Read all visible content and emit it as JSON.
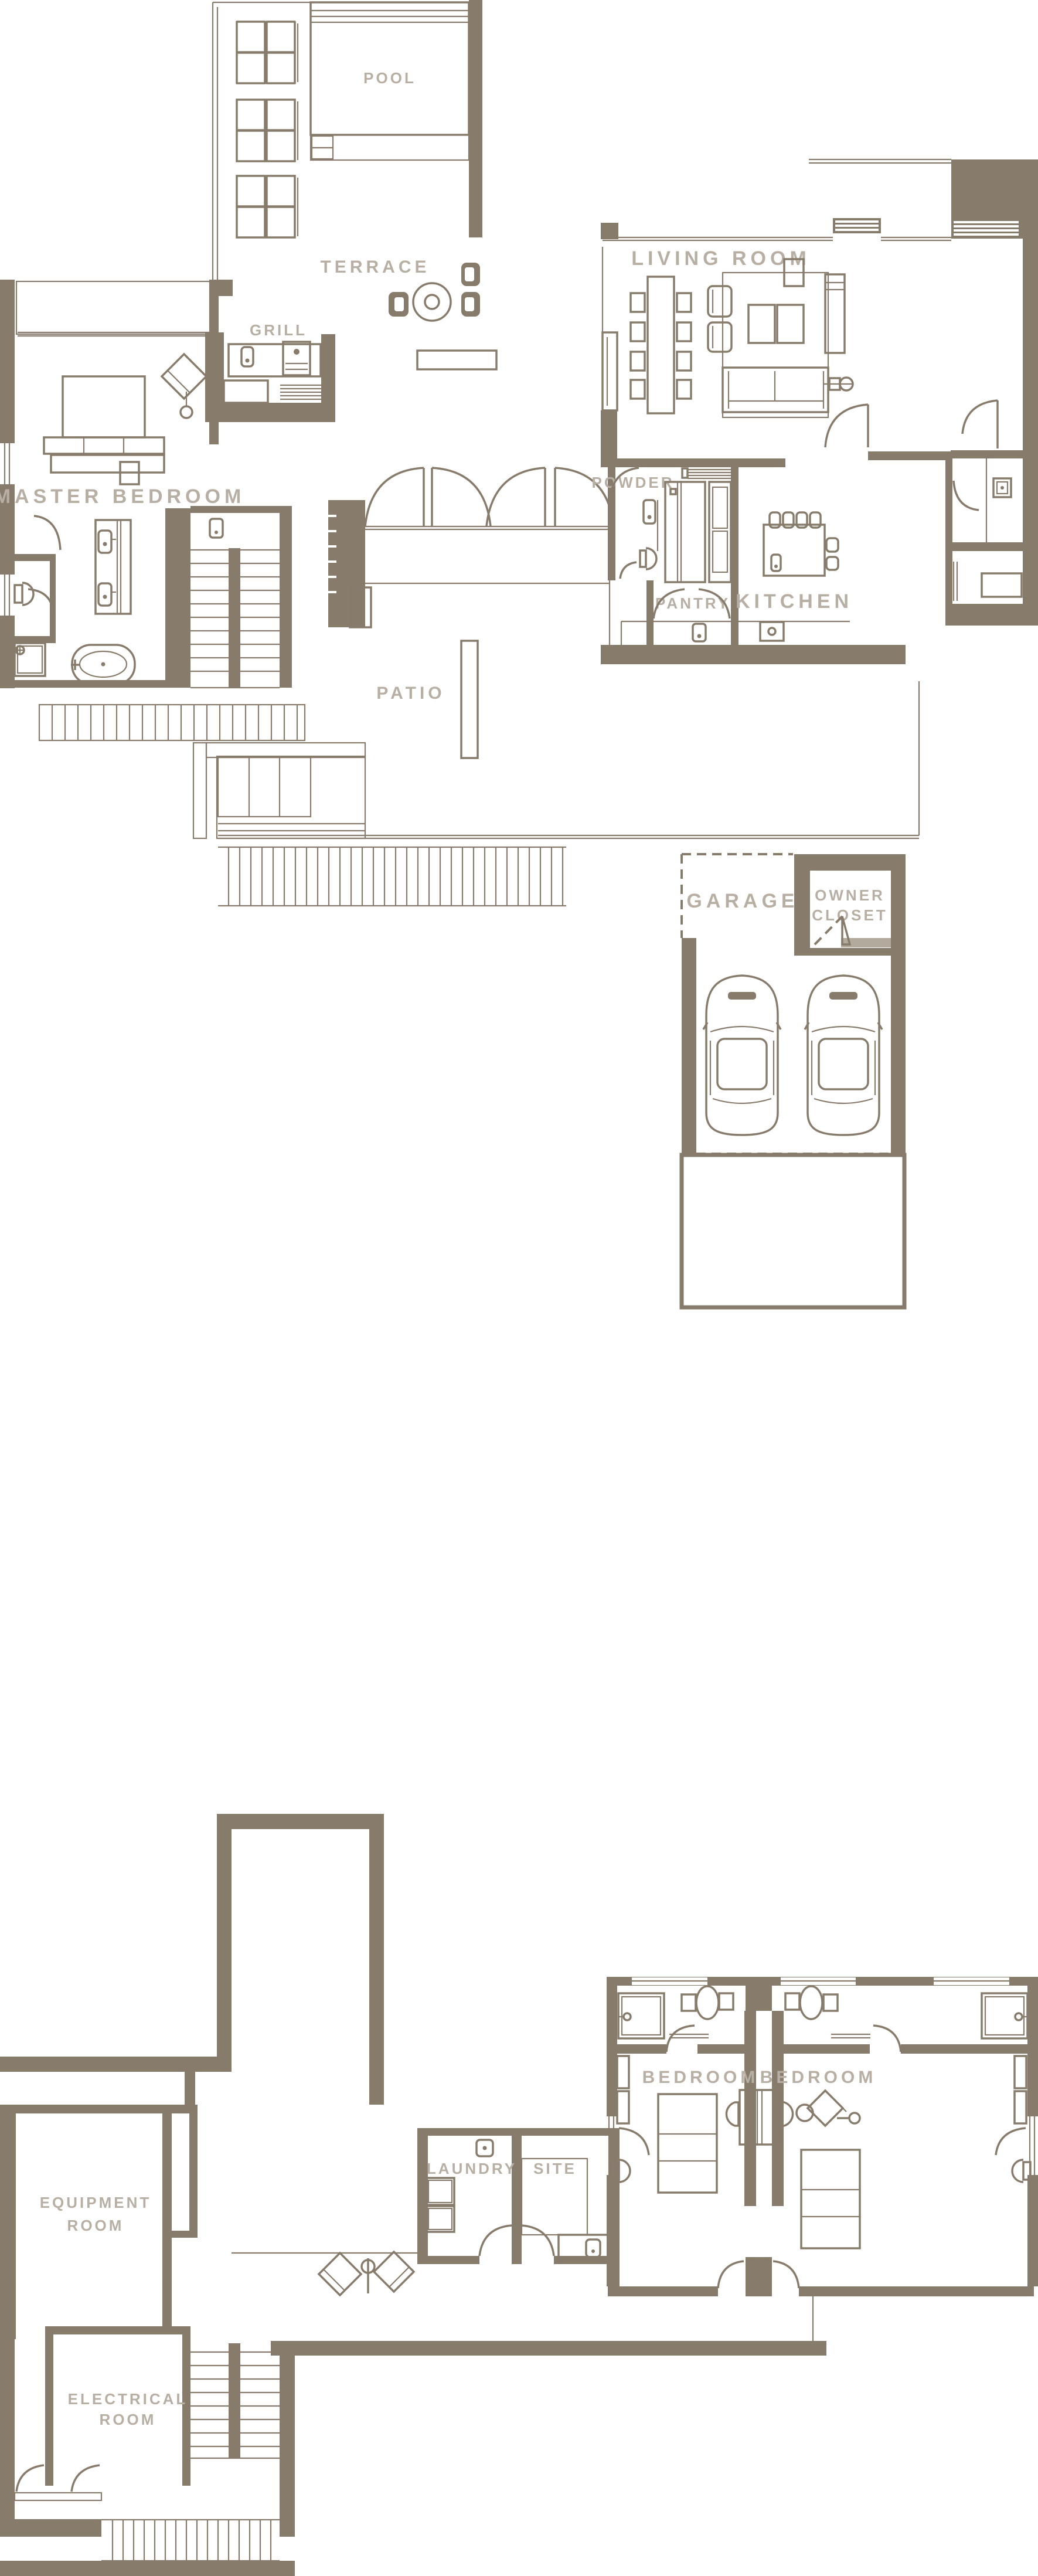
{
  "palette": {
    "wall_color": "#877b6c",
    "label_color": "#b8afa4",
    "door_slab_color": "#b3aa9e",
    "background_color": "#ffffff"
  },
  "floor_plan": {
    "type": "residential-floor-plan",
    "levels": [
      {
        "name": "main-level",
        "rooms": [
          "POOL",
          "TERRACE",
          "GRILL",
          "LIVING ROOM",
          "MASTER BEDROOM",
          "POWDER",
          "PANTRY",
          "KITCHEN",
          "PATIO"
        ]
      },
      {
        "name": "garage-level",
        "rooms": [
          "GARAGE",
          "OWNER CLOSET"
        ]
      },
      {
        "name": "lower-level",
        "rooms": [
          "EQUIPMENT ROOM",
          "LAUNDRY",
          "SITE",
          "BEDROOM",
          "BEDROOM",
          "ELECTRICAL ROOM"
        ]
      }
    ]
  },
  "rooms": {
    "pool": "POOL",
    "terrace": "TERRACE",
    "grill": "GRILL",
    "living_room": "LIVING ROOM",
    "master_bedroom": "MASTER BEDROOM",
    "powder": "POWDER",
    "pantry": "PANTRY",
    "kitchen": "KITCHEN",
    "patio": "PATIO",
    "garage": "GARAGE",
    "owner_closet_line1": "OWNER",
    "owner_closet_line2": "CLOSET",
    "equipment_line1": "EQUIPMENT",
    "equipment_line2": "ROOM",
    "laundry": "LAUNDRY",
    "site": "SITE",
    "bedroom_left": "BEDROOM",
    "bedroom_right": "BEDROOM",
    "electrical_line1": "ELECTRICAL",
    "electrical_line2": "ROOM"
  }
}
